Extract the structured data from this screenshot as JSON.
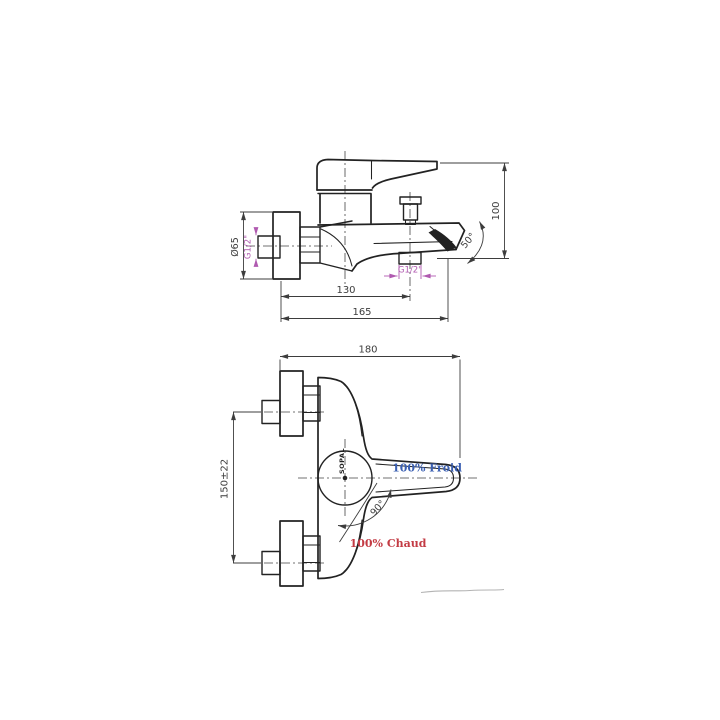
{
  "drawing": {
    "brand_mark": "SOPAL",
    "colors": {
      "line": "#222222",
      "dimension": "#3d3d3d",
      "thread_label": "#b05ab0",
      "cold_label": "#3a5fb2",
      "hot_label": "#c33b44"
    },
    "side_view": {
      "flange_diameter": "Ø65",
      "wall_inlet_thread": "G1/2\"",
      "height": "100",
      "spout_angle": "50°",
      "shower_outlet_thread": "G1/2\"",
      "wall_to_shower_outlet": "130",
      "wall_to_spout": "165"
    },
    "front_view": {
      "width": "180",
      "inlet_spacing": "150±22",
      "handle_rotation": "90°",
      "cold_label": "100% Froid",
      "hot_label": "100% Chaud"
    }
  }
}
